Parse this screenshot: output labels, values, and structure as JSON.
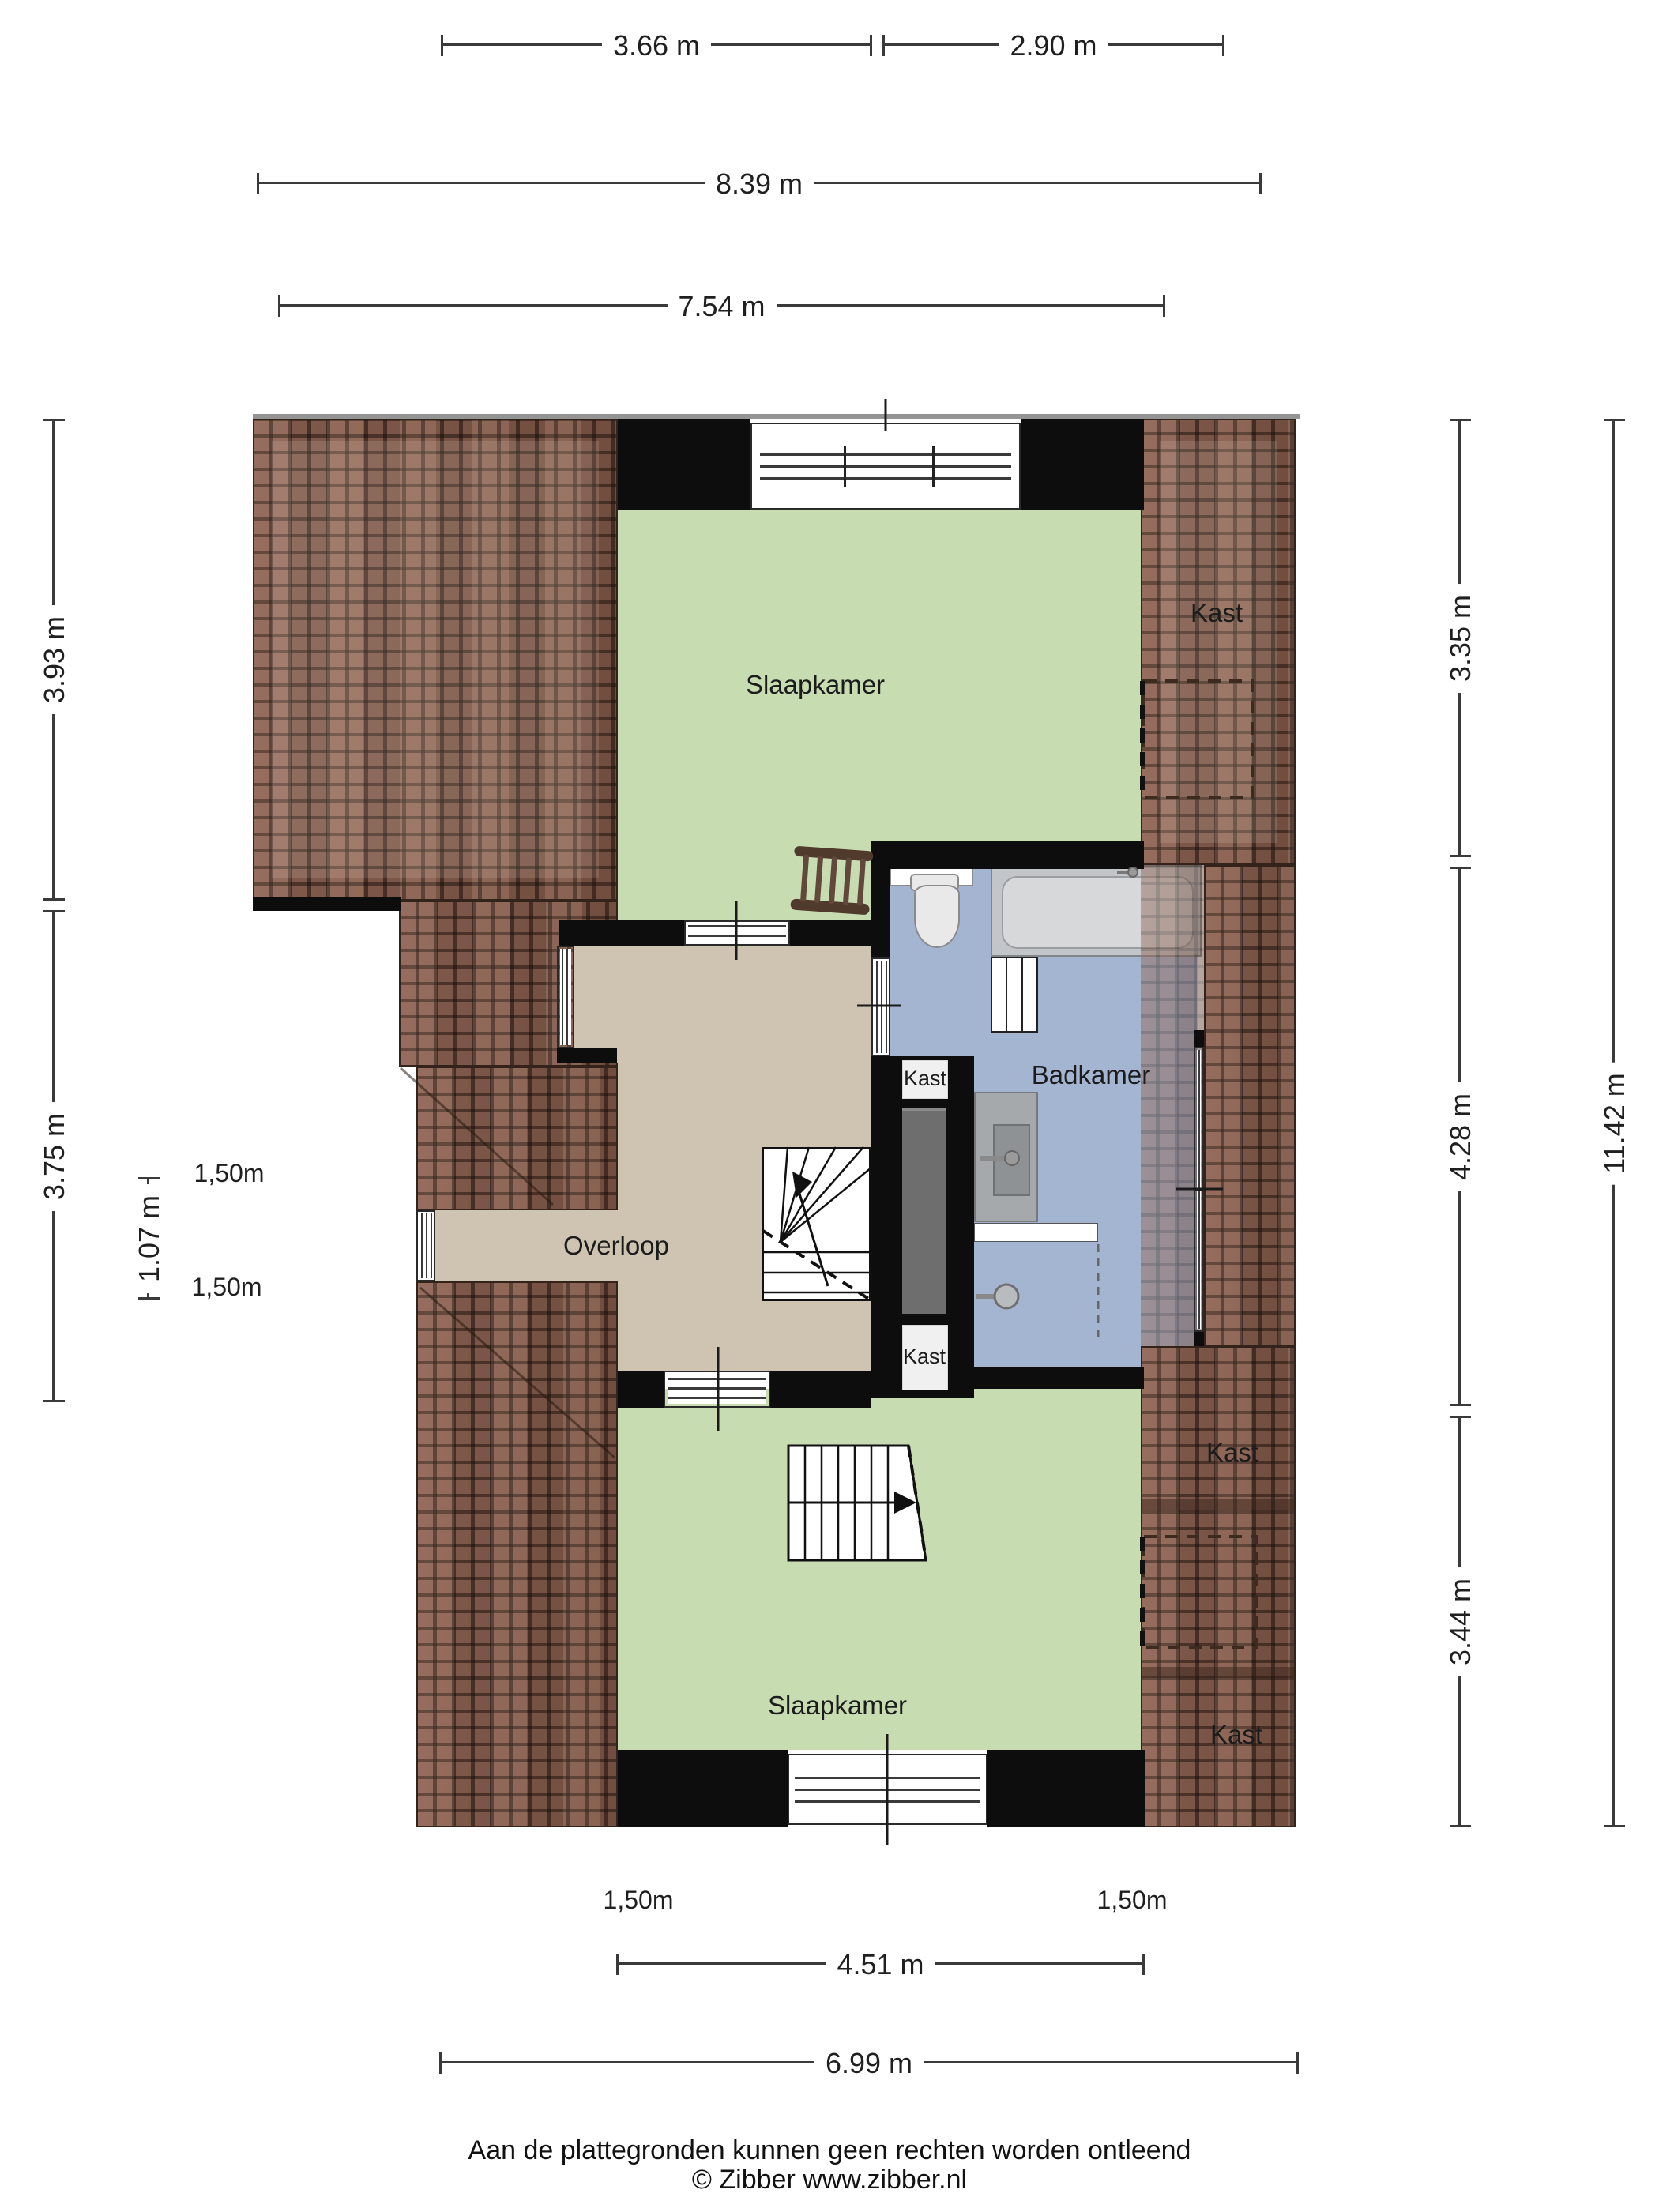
{
  "plan": {
    "rooms": {
      "bedroom_top_label": "Slaapkamer",
      "bedroom_bottom_label": "Slaapkamer",
      "landing_label": "Overloop",
      "bathroom_label": "Badkamer",
      "closet_label": "Kast"
    },
    "headroom_label": "1,50m",
    "colors": {
      "bedroom_floor": "#c8dcb2",
      "landing_floor": "#cfc3b1",
      "bathroom_floor": "#a4b5d1",
      "roof_tiles": "#82594a",
      "wall": "#0d0d0d",
      "closet_shaft": "#6e6e6e"
    }
  },
  "dimensions": {
    "top": [
      {
        "label": "3.66 m"
      },
      {
        "label": "2.90 m"
      },
      {
        "label": "8.39 m"
      },
      {
        "label": "7.54 m"
      }
    ],
    "left": [
      {
        "label": "3.93 m"
      },
      {
        "label": "3.75 m"
      },
      {
        "label": "1.07 m"
      }
    ],
    "right": [
      {
        "label": "3.35 m"
      },
      {
        "label": "4.28 m"
      },
      {
        "label": "3.44 m"
      },
      {
        "label": "11.42 m"
      }
    ],
    "bottom": [
      {
        "label": "4.51 m"
      },
      {
        "label": "6.99 m"
      }
    ]
  },
  "footer": {
    "disclaimer": "Aan de plattegronden kunnen geen rechten worden ontleend",
    "copyright": "© Zibber www.zibber.nl"
  }
}
